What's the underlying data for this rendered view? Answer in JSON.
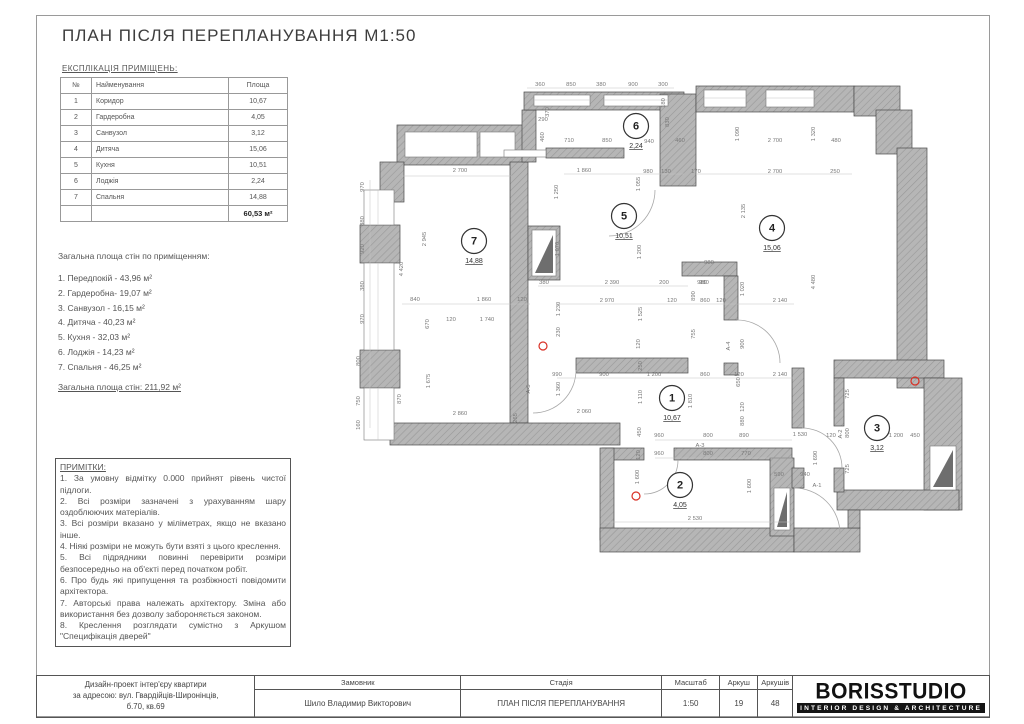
{
  "page": {
    "title": "ПЛАН ПІСЛЯ ПЕРЕПЛАНУВАННЯ М1:50"
  },
  "explication": {
    "heading": "ЕКСПЛІКАЦІЯ ПРИМІЩЕНЬ:",
    "columns": [
      "№",
      "Найменування",
      "Площа"
    ],
    "rows": [
      [
        "1",
        "Коридор",
        "10,67"
      ],
      [
        "2",
        "Гардеробна",
        "4,05"
      ],
      [
        "3",
        "Санвузол",
        "3,12"
      ],
      [
        "4",
        "Дитяча",
        "15,06"
      ],
      [
        "5",
        "Кухня",
        "10,51"
      ],
      [
        "6",
        "Лоджія",
        "2,24"
      ],
      [
        "7",
        "Спальня",
        "14,88"
      ]
    ],
    "total": "60,53 м²"
  },
  "wall_areas": {
    "heading": "Загальна площа стін по приміщенням:",
    "items": [
      "1. Передпокій -  43,96 м²",
      "2. Гардеробна-  19,07 м²",
      "3. Санвузол -  16,15 м²",
      "4. Дитяча -  40,23 м²",
      "5. Кухня -  32,03 м²",
      "6. Лоджія -  14,23 м²",
      "7. Спальня -  46,25 м²"
    ],
    "total": "Загальна площа стін: 211,92 м²"
  },
  "notes": {
    "heading": "ПРИМІТКИ:",
    "items": [
      "1. За умовну відмітку 0.000 прийнят рівень чистої підлоги.",
      "2. Всі розміри зазначені з урахуванням шару оздоблюючих матеріалів.",
      "3. Всі розміри вказано у міліметрах, якщо не вказано інше.",
      "4. Ніякі розміри не можуть бути взяті з цього креслення.",
      "5. Всі підрядники повинні перевірити розміри безпосередньо на об'єкті перед початком робіт.",
      "6. Про будь які припущення та розбіжності повідомити архітектора.",
      "7. Авторські права належать архітектору. Зміна або використання без дозволу забороняється законом.",
      "8. Креслення розглядати сумістно з Аркушом \"Специфікація дверей\""
    ]
  },
  "title_block": {
    "project_lines": [
      "Дизайн-проект інтер'єру квартири",
      "за адресою: вул. Гвардійців-Широнінців,",
      "б.70, кв.69"
    ],
    "client_label": "Замовник",
    "client_value": "Шило Владимир Викторович",
    "stage_label": "Стадія",
    "stage_value": "ПЛАН ПІСЛЯ ПЕРЕПЛАНУВАННЯ",
    "scale_label": "Масштаб",
    "scale_value": "1:50",
    "sheet_label": "Аркуш",
    "sheet_value": "19",
    "sheets_label": "Аркушів",
    "sheets_value": "48"
  },
  "logo": {
    "name": "BORISSTUDIO",
    "tagline": "INTERIOR DESIGN & ARCHITECTURE"
  },
  "colors": {
    "wall_fill": "#b6b6b6",
    "wall_hatch": "#989898",
    "wall_stroke": "#4a4a4a",
    "dim_text": "#787878",
    "marker_red": "#d93025",
    "shaft_dark": "#6e6e6e"
  },
  "plan": {
    "rooms": [
      {
        "num": "1",
        "area": "10,67",
        "x": 320,
        "y": 318
      },
      {
        "num": "2",
        "area": "4,05",
        "x": 328,
        "y": 405
      },
      {
        "num": "3",
        "area": "3,12",
        "x": 525,
        "y": 348
      },
      {
        "num": "4",
        "area": "15,06",
        "x": 420,
        "y": 148
      },
      {
        "num": "5",
        "area": "10,51",
        "x": 272,
        "y": 136
      },
      {
        "num": "6",
        "area": "2,24",
        "x": 284,
        "y": 46
      },
      {
        "num": "7",
        "area": "14,88",
        "x": 122,
        "y": 161
      }
    ],
    "walls": [
      [
        45,
        45,
        127,
        40
      ],
      [
        28,
        82,
        24,
        40
      ],
      [
        8,
        145,
        40,
        38
      ],
      [
        8,
        270,
        40,
        38
      ],
      [
        158,
        82,
        18,
        261
      ],
      [
        170,
        30,
        14,
        52
      ],
      [
        176,
        146,
        32,
        54
      ],
      [
        38,
        343,
        230,
        22
      ],
      [
        172,
        12,
        160,
        18
      ],
      [
        194,
        68,
        78,
        10
      ],
      [
        308,
        14,
        36,
        92
      ],
      [
        344,
        6,
        158,
        26
      ],
      [
        502,
        6,
        46,
        30
      ],
      [
        524,
        30,
        36,
        44
      ],
      [
        545,
        68,
        30,
        240
      ],
      [
        482,
        280,
        110,
        18
      ],
      [
        572,
        298,
        38,
        132
      ],
      [
        485,
        410,
        122,
        20
      ],
      [
        482,
        298,
        10,
        48
      ],
      [
        482,
        388,
        10,
        24
      ],
      [
        224,
        278,
        112,
        15
      ],
      [
        330,
        182,
        55,
        14
      ],
      [
        372,
        196,
        14,
        44
      ],
      [
        372,
        283,
        14,
        12
      ],
      [
        250,
        368,
        42,
        12
      ],
      [
        322,
        368,
        118,
        12
      ],
      [
        248,
        368,
        14,
        92
      ],
      [
        248,
        448,
        194,
        24
      ],
      [
        418,
        378,
        24,
        78
      ],
      [
        440,
        288,
        12,
        60
      ],
      [
        440,
        388,
        12,
        20
      ],
      [
        442,
        448,
        66,
        24
      ],
      [
        496,
        430,
        12,
        18
      ]
    ],
    "whites": [
      [
        53,
        52,
        72,
        25
      ],
      [
        128,
        52,
        35,
        25
      ],
      [
        180,
        150,
        24,
        46
      ],
      [
        578,
        366,
        26,
        44
      ],
      [
        422,
        408,
        16,
        42
      ],
      [
        182,
        15,
        56,
        11
      ],
      [
        252,
        15,
        64,
        11
      ],
      [
        352,
        10,
        42,
        17
      ],
      [
        414,
        10,
        48,
        17
      ],
      [
        12,
        110,
        30,
        35
      ],
      [
        12,
        183,
        30,
        87
      ],
      [
        12,
        308,
        30,
        52
      ],
      [
        152,
        70,
        42,
        7
      ]
    ],
    "tris": [
      [
        183,
        193,
        201,
        155,
        201,
        193
      ],
      [
        581,
        407,
        601,
        370,
        601,
        407
      ],
      [
        425,
        447,
        435,
        412,
        435,
        447
      ]
    ],
    "doors": [
      "M303,110 A46,46 0 0 1 257,156",
      "M385,240 A43,43 0 0 1 428,283",
      "M326,380 A34,34 0 0 1 292,414",
      "M224,290 A43,43 0 0 1 181,333",
      "M450,348 A40,40 0 0 1 490,388",
      "M442,408 A46,46 0 0 1 488,454"
    ],
    "lines": [
      [
        175,
        8,
        322,
        8
      ],
      [
        50,
        96,
        160,
        96
      ],
      [
        212,
        94,
        332,
        94
      ],
      [
        344,
        94,
        500,
        94
      ],
      [
        18,
        100,
        18,
        348
      ],
      [
        50,
        224,
        178,
        224
      ],
      [
        186,
        206,
        336,
        206
      ],
      [
        205,
        224,
        442,
        224
      ],
      [
        205,
        298,
        442,
        298
      ],
      [
        303,
        360,
        440,
        360
      ],
      [
        303,
        378,
        440,
        378
      ],
      [
        252,
        442,
        440,
        442
      ],
      [
        182,
        20,
        238,
        20
      ],
      [
        252,
        20,
        316,
        20
      ],
      [
        352,
        18,
        394,
        18
      ],
      [
        414,
        18,
        462,
        18
      ],
      [
        26,
        110,
        26,
        145
      ],
      [
        26,
        183,
        26,
        270
      ],
      [
        26,
        308,
        26,
        360
      ]
    ],
    "dims": [
      {
        "x": 188,
        "y": 6,
        "t": "360"
      },
      {
        "x": 219,
        "y": 6,
        "t": "850"
      },
      {
        "x": 249,
        "y": 6,
        "t": "380"
      },
      {
        "x": 281,
        "y": 6,
        "t": "900"
      },
      {
        "x": 311,
        "y": 6,
        "t": "300"
      },
      {
        "x": 191,
        "y": 41,
        "t": "290"
      },
      {
        "x": 197,
        "y": 32,
        "t": "370",
        "r": 1
      },
      {
        "x": 192,
        "y": 57,
        "t": "460",
        "r": 1
      },
      {
        "x": 217,
        "y": 62,
        "t": "710"
      },
      {
        "x": 255,
        "y": 62,
        "t": "850"
      },
      {
        "x": 297,
        "y": 63,
        "t": "940"
      },
      {
        "x": 328,
        "y": 62,
        "t": "460"
      },
      {
        "x": 313,
        "y": 23,
        "t": "180",
        "r": 1
      },
      {
        "x": 317,
        "y": 42,
        "t": "830",
        "r": 1
      },
      {
        "x": 387,
        "y": 54,
        "t": "1 090",
        "r": 1
      },
      {
        "x": 423,
        "y": 62,
        "t": "2 700"
      },
      {
        "x": 463,
        "y": 54,
        "t": "1 320",
        "r": 1
      },
      {
        "x": 484,
        "y": 62,
        "t": "480"
      },
      {
        "x": 108,
        "y": 92,
        "t": "2 700"
      },
      {
        "x": 232,
        "y": 92,
        "t": "1 860"
      },
      {
        "x": 296,
        "y": 93,
        "t": "980"
      },
      {
        "x": 314,
        "y": 93,
        "t": "130"
      },
      {
        "x": 344,
        "y": 93,
        "t": "170"
      },
      {
        "x": 423,
        "y": 93,
        "t": "2 700"
      },
      {
        "x": 483,
        "y": 93,
        "t": "250"
      },
      {
        "x": 12,
        "y": 107,
        "t": "970",
        "r": 1
      },
      {
        "x": 12,
        "y": 141,
        "t": "380",
        "r": 1
      },
      {
        "x": 12,
        "y": 169,
        "t": "920",
        "r": 1
      },
      {
        "x": 12,
        "y": 206,
        "t": "380",
        "r": 1
      },
      {
        "x": 12,
        "y": 239,
        "t": "970",
        "r": 1
      },
      {
        "x": 8,
        "y": 281,
        "t": "800",
        "r": 1
      },
      {
        "x": 8,
        "y": 321,
        "t": "750",
        "r": 1
      },
      {
        "x": 8,
        "y": 345,
        "t": "160",
        "r": 1
      },
      {
        "x": 74,
        "y": 159,
        "t": "2 945",
        "r": 1
      },
      {
        "x": 51,
        "y": 189,
        "t": "4 420",
        "r": 1
      },
      {
        "x": 78,
        "y": 301,
        "t": "1 675",
        "r": 1
      },
      {
        "x": 49,
        "y": 319,
        "t": "870",
        "r": 1
      },
      {
        "x": 63,
        "y": 221,
        "t": "840"
      },
      {
        "x": 132,
        "y": 221,
        "t": "1 860"
      },
      {
        "x": 170,
        "y": 221,
        "t": "120"
      },
      {
        "x": 99,
        "y": 241,
        "t": "120"
      },
      {
        "x": 135,
        "y": 241,
        "t": "1 740"
      },
      {
        "x": 77,
        "y": 244,
        "t": "670",
        "r": 1
      },
      {
        "x": 206,
        "y": 112,
        "t": "1 250",
        "r": 1
      },
      {
        "x": 207,
        "y": 169,
        "t": "1 070",
        "r": 1
      },
      {
        "x": 288,
        "y": 104,
        "t": "1 055",
        "r": 1
      },
      {
        "x": 289,
        "y": 172,
        "t": "1 200",
        "r": 1
      },
      {
        "x": 192,
        "y": 204,
        "t": "380"
      },
      {
        "x": 260,
        "y": 204,
        "t": "2 390"
      },
      {
        "x": 312,
        "y": 204,
        "t": "200"
      },
      {
        "x": 350,
        "y": 204,
        "t": "980"
      },
      {
        "x": 255,
        "y": 222,
        "t": "2 970"
      },
      {
        "x": 320,
        "y": 222,
        "t": "120"
      },
      {
        "x": 343,
        "y": 216,
        "t": "890",
        "r": 1
      },
      {
        "x": 353,
        "y": 222,
        "t": "860"
      },
      {
        "x": 369,
        "y": 222,
        "t": "120"
      },
      {
        "x": 392,
        "y": 209,
        "t": "1 020",
        "r": 1
      },
      {
        "x": 428,
        "y": 222,
        "t": "2 140"
      },
      {
        "x": 208,
        "y": 229,
        "t": "1 230",
        "r": 1
      },
      {
        "x": 290,
        "y": 234,
        "t": "1 525",
        "r": 1
      },
      {
        "x": 208,
        "y": 252,
        "t": "230",
        "r": 1
      },
      {
        "x": 288,
        "y": 264,
        "t": "120",
        "r": 1
      },
      {
        "x": 343,
        "y": 254,
        "t": "755",
        "r": 1
      },
      {
        "x": 290,
        "y": 286,
        "t": "250",
        "r": 1
      },
      {
        "x": 205,
        "y": 296,
        "t": "990"
      },
      {
        "x": 252,
        "y": 296,
        "t": "900"
      },
      {
        "x": 302,
        "y": 296,
        "t": "1 200"
      },
      {
        "x": 353,
        "y": 296,
        "t": "860"
      },
      {
        "x": 387,
        "y": 296,
        "t": "120"
      },
      {
        "x": 428,
        "y": 296,
        "t": "2 140"
      },
      {
        "x": 178,
        "y": 309,
        "t": "А-5",
        "r": 1
      },
      {
        "x": 208,
        "y": 309,
        "t": "1 360",
        "r": 1
      },
      {
        "x": 290,
        "y": 317,
        "t": "1 110",
        "r": 1
      },
      {
        "x": 340,
        "y": 321,
        "t": "1 810",
        "r": 1
      },
      {
        "x": 378,
        "y": 266,
        "t": "А-4",
        "r": 1
      },
      {
        "x": 392,
        "y": 264,
        "t": "900",
        "r": 1
      },
      {
        "x": 388,
        "y": 302,
        "t": "650",
        "r": 1
      },
      {
        "x": 357,
        "y": 184,
        "t": "980"
      },
      {
        "x": 352,
        "y": 204,
        "t": "980"
      },
      {
        "x": 393,
        "y": 131,
        "t": "2 135",
        "r": 1
      },
      {
        "x": 463,
        "y": 202,
        "t": "4 480",
        "r": 1
      },
      {
        "x": 108,
        "y": 335,
        "t": "2 860"
      },
      {
        "x": 232,
        "y": 333,
        "t": "2 060"
      },
      {
        "x": 165,
        "y": 338,
        "t": "265",
        "r": 1
      },
      {
        "x": 289,
        "y": 352,
        "t": "450",
        "r": 1
      },
      {
        "x": 307,
        "y": 357,
        "t": "960"
      },
      {
        "x": 356,
        "y": 357,
        "t": "800"
      },
      {
        "x": 392,
        "y": 357,
        "t": "890"
      },
      {
        "x": 348,
        "y": 367,
        "t": "А-3"
      },
      {
        "x": 307,
        "y": 375,
        "t": "960"
      },
      {
        "x": 356,
        "y": 375,
        "t": "800"
      },
      {
        "x": 394,
        "y": 375,
        "t": "770"
      },
      {
        "x": 288,
        "y": 375,
        "t": "120",
        "r": 1
      },
      {
        "x": 287,
        "y": 397,
        "t": "1 600",
        "r": 1
      },
      {
        "x": 399,
        "y": 406,
        "t": "1 600",
        "r": 1
      },
      {
        "x": 343,
        "y": 440,
        "t": "2 530"
      },
      {
        "x": 392,
        "y": 341,
        "t": "880",
        "r": 1
      },
      {
        "x": 392,
        "y": 327,
        "t": "120",
        "r": 1
      },
      {
        "x": 448,
        "y": 356,
        "t": "1 530"
      },
      {
        "x": 479,
        "y": 357,
        "t": "120"
      },
      {
        "x": 465,
        "y": 378,
        "t": "1 690",
        "r": 1
      },
      {
        "x": 427,
        "y": 396,
        "t": "590"
      },
      {
        "x": 453,
        "y": 396,
        "t": "940"
      },
      {
        "x": 465,
        "y": 407,
        "t": "А-1"
      },
      {
        "x": 497,
        "y": 314,
        "t": "725",
        "r": 1
      },
      {
        "x": 497,
        "y": 353,
        "t": "800",
        "r": 1
      },
      {
        "x": 497,
        "y": 389,
        "t": "725",
        "r": 1
      },
      {
        "x": 490,
        "y": 354,
        "t": "А-2",
        "r": 1
      },
      {
        "x": 544,
        "y": 357,
        "t": "1 200"
      },
      {
        "x": 563,
        "y": 357,
        "t": "450"
      }
    ],
    "markers": [
      [
        191,
        266
      ],
      [
        284,
        416
      ],
      [
        563,
        301
      ]
    ]
  }
}
